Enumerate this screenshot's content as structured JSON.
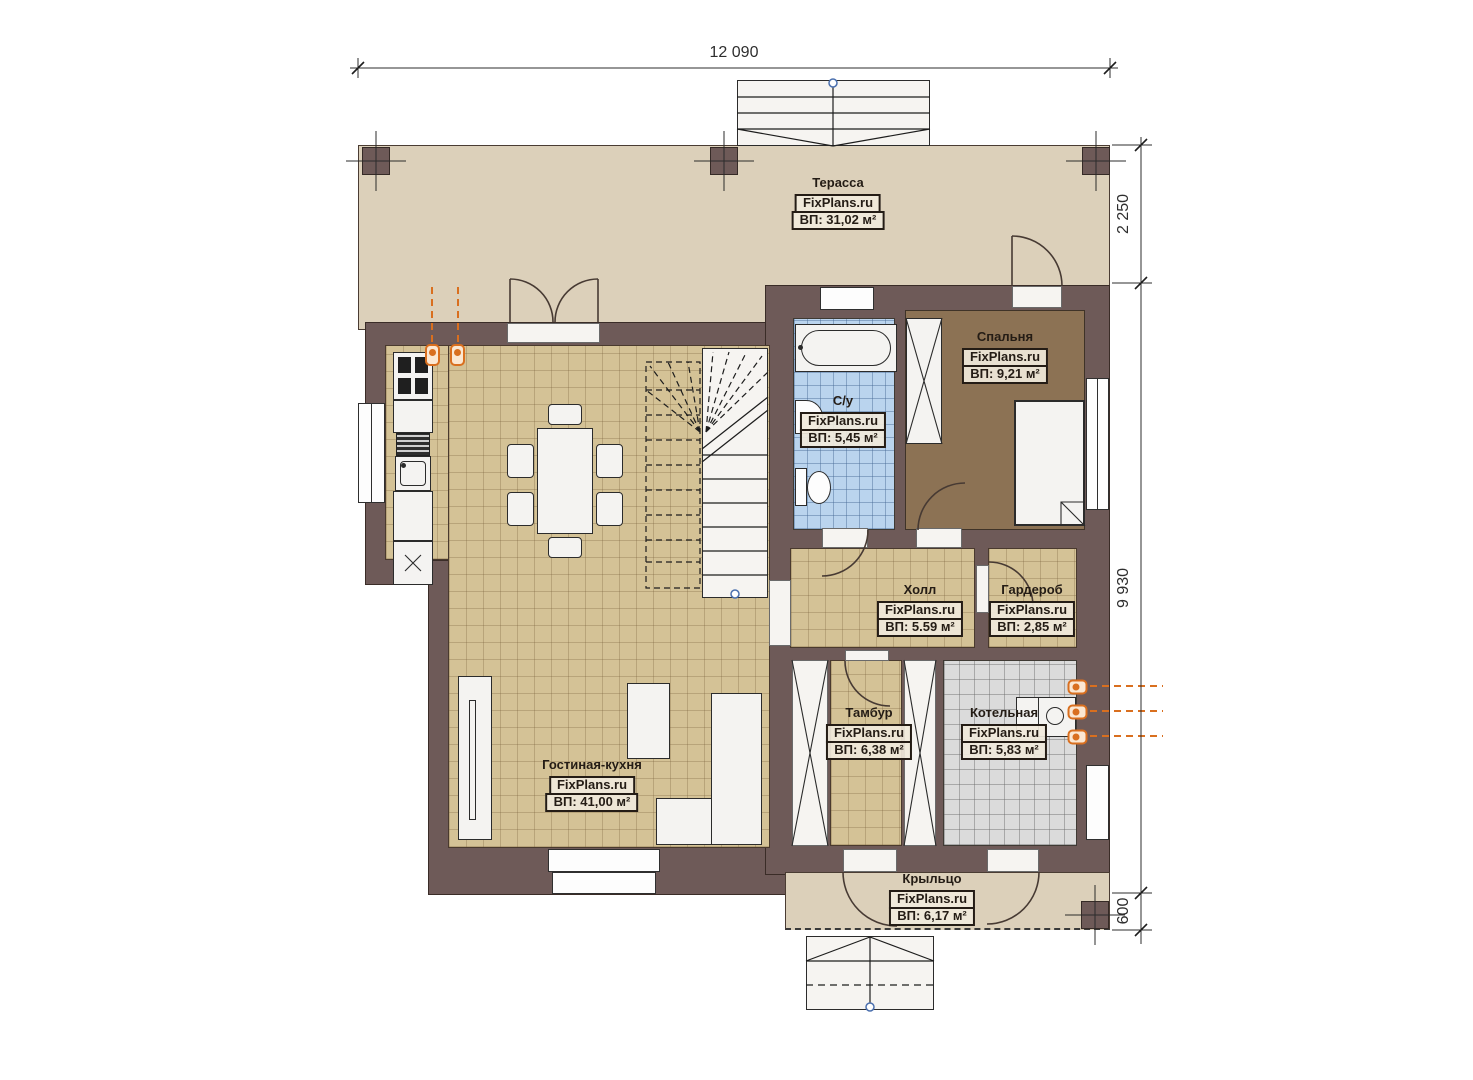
{
  "dimensions": {
    "width_top": "12 090",
    "right_terrace": "2 250",
    "right_house": "9 930",
    "right_porch": "600"
  },
  "rooms": {
    "terrace": {
      "name": "Терасса",
      "brand": "FixPlans.ru",
      "area": "ВП: 31,02 м²"
    },
    "bedroom": {
      "name": "Спальня",
      "brand": "FixPlans.ru",
      "area": "ВП: 9,21 м²"
    },
    "bathroom": {
      "name": "С/у",
      "brand": "FixPlans.ru",
      "area": "ВП: 5,45 м²"
    },
    "hall": {
      "name": "Холл",
      "brand": "FixPlans.ru",
      "area": "ВП: 5.59 м²"
    },
    "wardrobe": {
      "name": "Гардероб",
      "brand": "FixPlans.ru",
      "area": "ВП: 2,85 м²"
    },
    "vestibule": {
      "name": "Тамбур",
      "brand": "FixPlans.ru",
      "area": "ВП: 6,38 м²"
    },
    "boiler_room": {
      "name": "Котельная",
      "brand": "FixPlans.ru",
      "area": "ВП: 5,83 м²"
    },
    "living_kitchen": {
      "name": "Гостиная-кухня",
      "brand": "FixPlans.ru",
      "area": "ВП: 41,00 м²"
    },
    "porch": {
      "name": "Крыльцо",
      "brand": "FixPlans.ru",
      "area": "ВП: 6,17 м²"
    }
  },
  "colors": {
    "wall": "#6e5a58",
    "terrace_floor": "#dcd0ba",
    "tile_floor": "#d4c296",
    "bedroom_floor": "#8c7254",
    "bathroom_floor": "#bad4ee",
    "boiler_floor": "#dbdbdb",
    "accent_orange": "#d96f1f"
  }
}
